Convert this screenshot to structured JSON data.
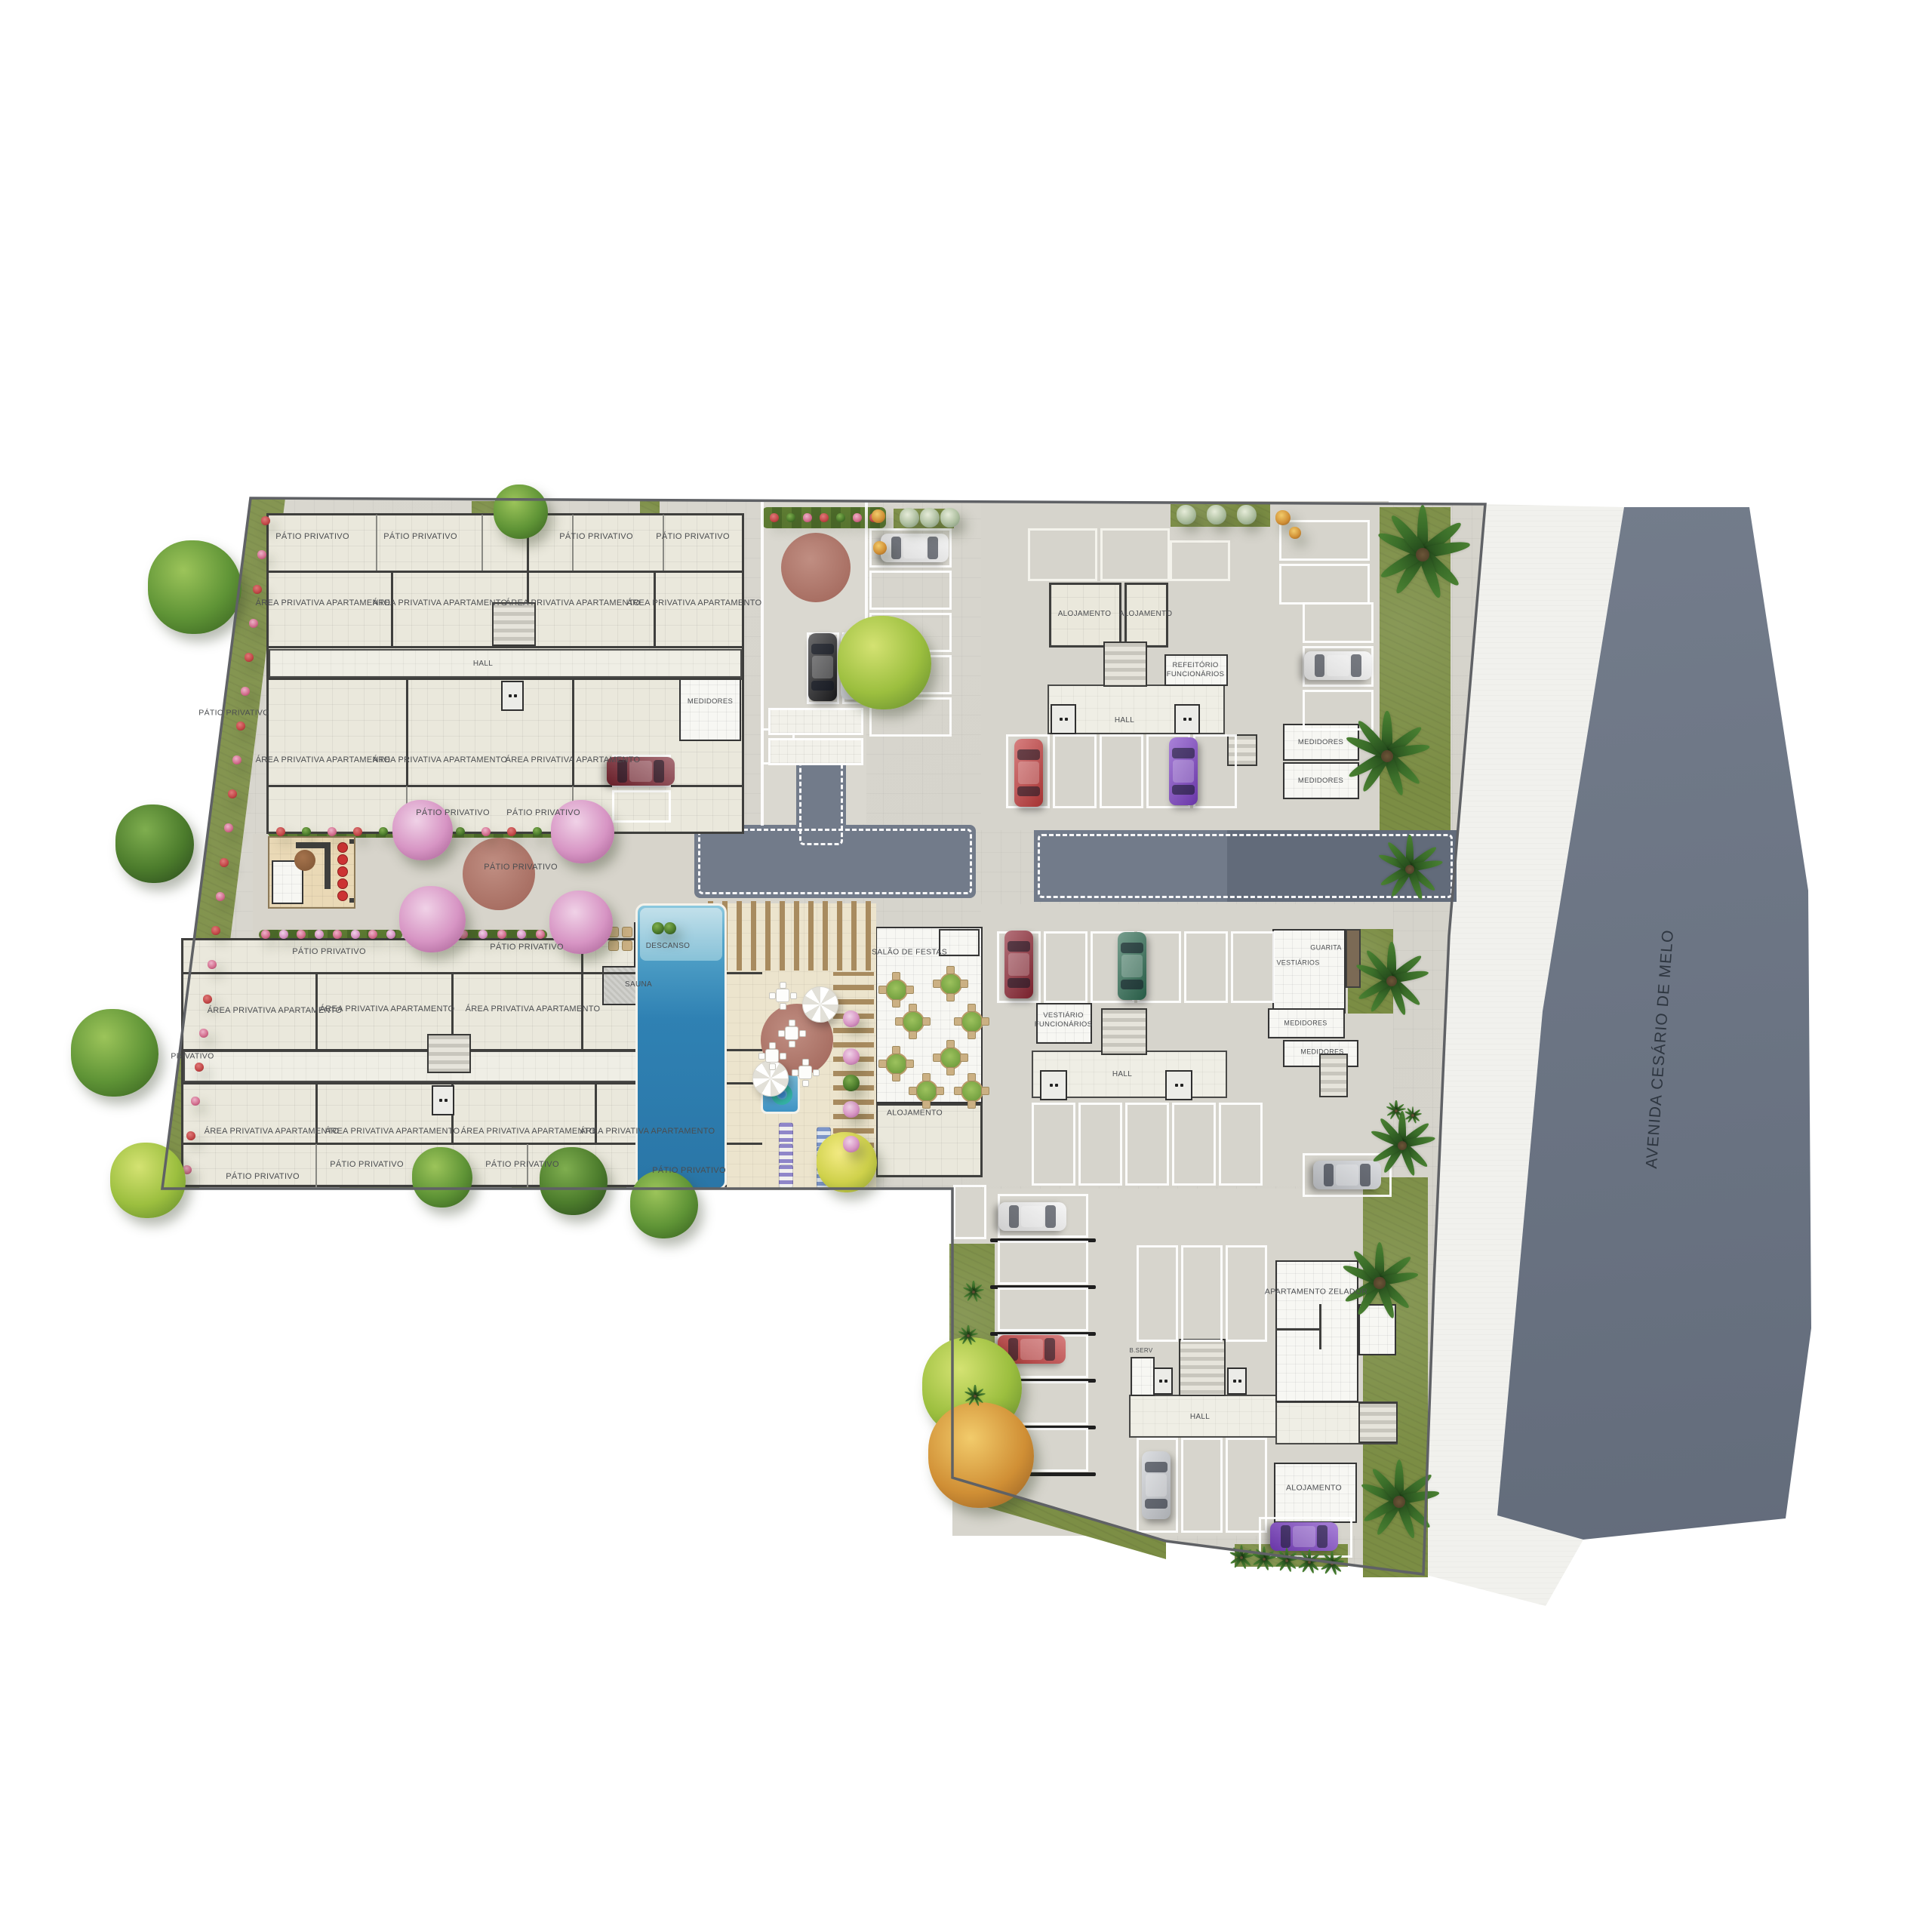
{
  "street": {
    "label": "AVENIDA CESÁRIO DE MELO"
  },
  "colors": {
    "paving": "#d8d6ce",
    "road": "#727b8a",
    "avenue_top": "#7e8796",
    "avenue_bottom": "#5d6675",
    "sidewalk": "#f1f1ed",
    "grass": "#7b8d44",
    "building_tile": "#eae8dc",
    "wall": "#3f3f3d",
    "plaza_red": "#a86f63",
    "pool_blue": "#2f81b3",
    "stall_line": "#ffffff"
  },
  "polys": {
    "site": "332,660 1968,668 1920,1240 1900,1700 1886,2086 1545,2042 1262,1958 1262,1575 215,1575",
    "sidewalk": "1968,668 2152,672 2044,1340 1984,2008 2098,2040 2048,2128 1886,2086 1900,1700 1920,1240",
    "avenue_curb": "2152,672 2168,672 2058,1340 1998,2010 1984,2008 2044,1340",
    "avenue": "2152,672 2318,672 2396,1180 2400,1760 2366,2012 2212,2028 2098,2040 1984,2008 2044,1340",
    "left_strip": "332,660 378,660 264,1575 215,1575",
    "bottom_wedge": "1262,1958 1545,2042 1545,2066 1262,1984"
  },
  "zones": [
    [
      1008,
      664,
      140,
      428,
      "#dad8d0"
    ],
    [
      335,
      1105,
      673,
      138,
      "#d7d4cb"
    ],
    [
      1300,
      664,
      540,
      436,
      "#d6d4cc"
    ],
    [
      1300,
      1198,
      546,
      374,
      "#d6d4cc"
    ],
    [
      1262,
      1575,
      606,
      460,
      "#d7d5cd"
    ]
  ],
  "roads": {
    "stem": [
      1055,
      984,
      66,
      112
    ],
    "a": [
      920,
      1093,
      373,
      97
    ],
    "b": [
      1370,
      1100,
      560,
      95
    ],
    "b_dark": [
      1626,
      1100,
      304,
      95
    ]
  },
  "curbs": [
    [
      1008,
      664,
      4,
      430
    ],
    [
      1146,
      664,
      4,
      178
    ]
  ],
  "grass": [
    [
      625,
      664,
      70,
      68
    ],
    [
      848,
      664,
      26,
      66
    ],
    [
      1184,
      674,
      80,
      26
    ],
    [
      1551,
      668,
      132,
      30
    ],
    [
      1828,
      672,
      94,
      518
    ],
    [
      1786,
      1231,
      60,
      112
    ],
    [
      1806,
      1560,
      86,
      530
    ],
    [
      1258,
      1648,
      60,
      316
    ],
    [
      450,
      1556,
      160,
      18
    ],
    [
      678,
      1556,
      152,
      18
    ],
    [
      795,
      1005,
      10,
      84
    ],
    [
      1106,
      1298,
      42,
      240
    ],
    [
      1636,
      2046,
      150,
      30
    ]
  ],
  "hedges": [
    [
      1010,
      672,
      164,
      28
    ],
    [
      355,
      1096,
      445,
      14
    ],
    [
      343,
      1232,
      190,
      13
    ],
    [
      607,
      1232,
      118,
      13
    ]
  ],
  "flower_rows": [
    [
      352,
      690,
      248,
      1550,
      20,
      "red"
    ],
    [
      372,
      1102,
      780,
      1102,
      13,
      "mix"
    ],
    [
      352,
      1238,
      518,
      1238,
      8,
      "pink"
    ],
    [
      614,
      1238,
      716,
      1238,
      5,
      "pink"
    ],
    [
      1026,
      686,
      1158,
      686,
      7,
      "mix"
    ]
  ],
  "rooms": [
    [
      353,
      680,
      633,
      425,
      "plate"
    ],
    [
      240,
      1243,
      770,
      330,
      "plate"
    ],
    [
      356,
      860,
      627,
      38,
      "cor"
    ],
    [
      243,
      1392,
      764,
      42,
      "cor"
    ],
    [
      1388,
      907,
      235,
      66,
      "cor"
    ],
    [
      1367,
      1392,
      259,
      63,
      "cor"
    ],
    [
      1496,
      1848,
      214,
      57,
      "cor"
    ],
    [
      1690,
      1857,
      162,
      57,
      "cor"
    ],
    [
      900,
      898,
      82,
      84,
      "white"
    ],
    [
      840,
      1222,
      100,
      60,
      "white"
    ],
    [
      798,
      1280,
      62,
      52,
      "gray"
    ],
    [
      898,
      1282,
      42,
      60,
      "white"
    ],
    [
      1390,
      772,
      96,
      86,
      "tile"
    ],
    [
      1490,
      772,
      58,
      86,
      "tile"
    ],
    [
      1543,
      867,
      84,
      42,
      "white"
    ],
    [
      1700,
      959,
      101,
      49,
      "white"
    ],
    [
      1700,
      1010,
      101,
      49,
      "white"
    ],
    [
      1373,
      1329,
      74,
      54,
      "white"
    ],
    [
      1686,
      1231,
      97,
      112,
      "white"
    ],
    [
      1783,
      1231,
      20,
      78,
      "brown"
    ],
    [
      1680,
      1336,
      102,
      40,
      "white"
    ],
    [
      1700,
      1378,
      100,
      36,
      "white"
    ],
    [
      1690,
      1670,
      110,
      188,
      "white"
    ],
    [
      1800,
      1728,
      50,
      68,
      "white"
    ],
    [
      1498,
      1798,
      32,
      52,
      "white"
    ],
    [
      1688,
      1938,
      110,
      80,
      "white"
    ],
    [
      1160,
      1228,
      142,
      234,
      "white"
    ],
    [
      1160,
      1462,
      142,
      98,
      "tile"
    ],
    [
      1244,
      1231,
      54,
      36,
      "white2"
    ],
    [
      963,
      1197,
      198,
      380,
      "deck"
    ],
    [
      355,
      1108,
      116,
      96,
      "tan"
    ],
    [
      360,
      1140,
      42,
      58,
      "white"
    ],
    [
      806,
      1228,
      14,
      14,
      "tan2"
    ],
    [
      824,
      1228,
      14,
      14,
      "tan2"
    ],
    [
      806,
      1246,
      14,
      14,
      "tan2"
    ],
    [
      824,
      1246,
      14,
      14,
      "tan2"
    ]
  ],
  "walls": [
    [
      353,
      756,
      633,
      3
    ],
    [
      353,
      856,
      633,
      3
    ],
    [
      353,
      898,
      633,
      3
    ],
    [
      353,
      1040,
      633,
      3
    ],
    [
      518,
      756,
      3,
      100
    ],
    [
      698,
      682,
      3,
      174
    ],
    [
      866,
      756,
      3,
      100
    ],
    [
      538,
      898,
      3,
      142
    ],
    [
      758,
      898,
      3,
      142
    ],
    [
      240,
      1288,
      770,
      3
    ],
    [
      240,
      1390,
      770,
      3
    ],
    [
      240,
      1434,
      770,
      3
    ],
    [
      240,
      1514,
      770,
      3
    ],
    [
      418,
      1288,
      3,
      102
    ],
    [
      598,
      1288,
      3,
      102
    ],
    [
      770,
      1243,
      3,
      147
    ],
    [
      418,
      1434,
      3,
      80
    ],
    [
      598,
      1434,
      3,
      80
    ],
    [
      788,
      1434,
      3,
      80
    ],
    [
      392,
      1116,
      46,
      8
    ],
    [
      430,
      1116,
      8,
      62
    ],
    [
      463,
      1112,
      6,
      6
    ],
    [
      463,
      1190,
      6,
      6
    ],
    [
      1690,
      1760,
      60,
      3
    ],
    [
      1748,
      1728,
      3,
      60
    ]
  ],
  "lwalls": [
    [
      498,
      682,
      2,
      74
    ],
    [
      638,
      682,
      2,
      74
    ],
    [
      758,
      682,
      2,
      74
    ],
    [
      878,
      682,
      2,
      74
    ],
    [
      538,
      1042,
      2,
      63
    ],
    [
      758,
      1042,
      2,
      63
    ],
    [
      418,
      1516,
      2,
      57
    ],
    [
      698,
      1516,
      2,
      57
    ]
  ],
  "stairs": [
    [
      652,
      798,
      58,
      58
    ],
    [
      566,
      1370,
      58,
      52
    ],
    [
      1462,
      850,
      58,
      60
    ],
    [
      1459,
      1336,
      61,
      62
    ],
    [
      1748,
      1396,
      38,
      58
    ],
    [
      1562,
      1774,
      62,
      76
    ],
    [
      1800,
      1858,
      52,
      54
    ],
    [
      1626,
      973,
      40,
      42
    ]
  ],
  "lifts": [
    [
      664,
      902,
      30,
      40
    ],
    [
      572,
      1438,
      30,
      40
    ],
    [
      1392,
      933,
      34,
      40
    ],
    [
      1556,
      933,
      34,
      40
    ],
    [
      1378,
      1418,
      36,
      40
    ],
    [
      1544,
      1418,
      36,
      40
    ],
    [
      1528,
      1812,
      26,
      36
    ],
    [
      1626,
      1812,
      26,
      36
    ]
  ],
  "stall_groups": [
    [
      1152,
      700,
      109,
      52,
      5,
      "col",
      "w"
    ],
    [
      1069,
      838,
      43,
      95,
      2,
      "row",
      "w"
    ],
    [
      811,
      1000,
      78,
      43,
      2,
      "col",
      "w"
    ],
    [
      1009,
      965,
      44,
      48,
      1,
      "col",
      "w"
    ],
    [
      1695,
      689,
      120,
      54,
      2,
      "col",
      "w"
    ],
    [
      1333,
      973,
      58,
      98,
      5,
      "row",
      "w"
    ],
    [
      1726,
      798,
      94,
      54,
      3,
      "col",
      "w"
    ],
    [
      1321,
      1234,
      58,
      95,
      6,
      "row",
      "w"
    ],
    [
      1367,
      1461,
      58,
      110,
      5,
      "row",
      "w"
    ],
    [
      1726,
      1528,
      118,
      58,
      1,
      "col",
      "w"
    ],
    [
      1322,
      1582,
      120,
      58,
      6,
      "col",
      "d"
    ],
    [
      1263,
      1570,
      44,
      72,
      1,
      "row",
      "w"
    ],
    [
      1506,
      1650,
      55,
      128,
      3,
      "row",
      "d"
    ],
    [
      1506,
      1905,
      55,
      126,
      3,
      "row",
      "d"
    ],
    [
      1668,
      2010,
      124,
      54,
      1,
      "col",
      "w"
    ],
    [
      1362,
      700,
      92,
      70,
      2,
      "row",
      "t"
    ],
    [
      1550,
      716,
      80,
      54,
      1,
      "row",
      "t"
    ],
    [
      1018,
      938,
      126,
      36,
      2,
      "col",
      "tile"
    ]
  ],
  "circles": [
    [
      1081,
      752,
      46,
      "red"
    ],
    [
      661,
      1158,
      48,
      "red"
    ],
    [
      1056,
      1378,
      48,
      "red"
    ],
    [
      404,
      1140,
      14,
      "grill"
    ],
    [
      453,
      1122,
      6,
      "stool"
    ],
    [
      453,
      1138,
      6,
      "stool"
    ],
    [
      453,
      1154,
      6,
      "stool"
    ],
    [
      453,
      1170,
      6,
      "stool"
    ],
    [
      453,
      1186,
      6,
      "stool"
    ]
  ],
  "pool": {
    "main": [
      842,
      1197,
      121,
      380
    ],
    "beach": [
      848,
      1203,
      109,
      70
    ],
    "kids": [
      1008,
      1420,
      52,
      56
    ],
    "float": [
      1022,
      1436,
      28,
      28
    ]
  },
  "pergolas": [
    [
      938,
      1194,
      216,
      92,
      "v"
    ],
    [
      1104,
      1288,
      54,
      252,
      "h"
    ]
  ],
  "umbrellas": [
    [
      1086,
      1330,
      23
    ],
    [
      1020,
      1428,
      23
    ]
  ],
  "tables_salao": [
    [
      1186,
      1310
    ],
    [
      1258,
      1302
    ],
    [
      1286,
      1352
    ],
    [
      1208,
      1352
    ],
    [
      1186,
      1408
    ],
    [
      1258,
      1400
    ],
    [
      1286,
      1444
    ],
    [
      1226,
      1444
    ]
  ],
  "tables_pool": [
    [
      1036,
      1318
    ],
    [
      1022,
      1398
    ],
    [
      1066,
      1420
    ],
    [
      1048,
      1368
    ]
  ],
  "loungers": [
    [
      1040,
      1502,
      "purple"
    ],
    [
      1040,
      1530,
      "purple"
    ],
    [
      1040,
      1558,
      "purple"
    ],
    [
      1090,
      1508,
      "blue"
    ],
    [
      1090,
      1534,
      "blue"
    ],
    [
      1090,
      1560,
      "blue"
    ]
  ],
  "cars": [
    [
      "#f2f2f2",
      1212,
      726,
      90
    ],
    [
      "#1d1d1f",
      1090,
      884,
      0
    ],
    [
      "#c9ccd1",
      1133,
      882,
      0
    ],
    [
      "#7a2430",
      849,
      1022,
      90
    ],
    [
      "#c23b3b",
      1363,
      1024,
      0
    ],
    [
      "#7b3fc4",
      1568,
      1022,
      0
    ],
    [
      "#f2f2f2",
      1773,
      882,
      90
    ],
    [
      "#8c2633",
      1350,
      1278,
      0
    ],
    [
      "#2e6b52",
      1500,
      1280,
      0
    ],
    [
      "#c9ccd1",
      1785,
      1557,
      90
    ],
    [
      "#f2f2f2",
      1368,
      1612,
      90
    ],
    [
      "#c23b3b",
      1367,
      1788,
      90
    ],
    [
      "#c9ccd1",
      1532,
      1968,
      0
    ],
    [
      "#7b3fc4",
      1728,
      2036,
      90
    ]
  ],
  "trees": [
    [
      "green",
      258,
      778,
      62
    ],
    [
      "dark",
      205,
      1118,
      52
    ],
    [
      "green",
      152,
      1395,
      58
    ],
    [
      "lime",
      196,
      1564,
      50
    ],
    [
      "green",
      690,
      678,
      36
    ],
    [
      "lime",
      1172,
      878,
      62
    ],
    [
      "pink",
      560,
      1100,
      40
    ],
    [
      "pink",
      772,
      1102,
      42
    ],
    [
      "pink",
      573,
      1218,
      44
    ],
    [
      "pink",
      770,
      1222,
      42
    ],
    [
      "green",
      586,
      1560,
      40
    ],
    [
      "dark",
      760,
      1565,
      45
    ],
    [
      "green",
      880,
      1596,
      45
    ],
    [
      "lime",
      1288,
      1838,
      66
    ],
    [
      "orange",
      1300,
      1928,
      70
    ],
    [
      "yellow",
      1122,
      1540,
      40
    ],
    [
      "shrub",
      1205,
      686,
      13
    ],
    [
      "shrub",
      1232,
      686,
      13
    ],
    [
      "shrub",
      1259,
      686,
      13
    ],
    [
      "shrub",
      1572,
      682,
      13
    ],
    [
      "shrub",
      1612,
      682,
      13
    ],
    [
      "shrub",
      1652,
      682,
      13
    ],
    [
      "orange",
      1164,
      684,
      9
    ],
    [
      "orange",
      1166,
      726,
      9
    ],
    [
      "orange",
      1700,
      686,
      10
    ],
    [
      "orange",
      1716,
      706,
      8
    ],
    [
      "pink",
      1128,
      1350,
      11
    ],
    [
      "pink",
      1128,
      1400,
      11
    ],
    [
      "pink",
      1128,
      1470,
      11
    ],
    [
      "pink",
      1128,
      1516,
      11
    ],
    [
      "dark",
      1128,
      1435,
      11
    ],
    [
      "dark",
      872,
      1230,
      8
    ],
    [
      "dark",
      888,
      1230,
      8
    ]
  ],
  "palms": [
    [
      1885,
      735,
      66
    ],
    [
      1838,
      1002,
      60
    ],
    [
      1868,
      1152,
      46
    ],
    [
      1844,
      1300,
      52
    ],
    [
      1858,
      1518,
      46
    ],
    [
      1828,
      1700,
      54
    ],
    [
      1854,
      1990,
      56
    ],
    [
      1850,
      1472,
      14
    ],
    [
      1872,
      1478,
      12
    ],
    [
      1290,
      1712,
      15
    ],
    [
      1283,
      1770,
      14
    ],
    [
      1292,
      1850,
      15
    ],
    [
      1645,
      2064,
      17
    ],
    [
      1675,
      2066,
      17
    ],
    [
      1705,
      2068,
      17
    ],
    [
      1735,
      2070,
      17
    ],
    [
      1765,
      2072,
      17
    ]
  ],
  "labels": [
    [
      "PÁTIO PRIVATIVO",
      414,
      712,
      11
    ],
    [
      "PÁTIO PRIVATIVO",
      557,
      712,
      11
    ],
    [
      "PÁTIO PRIVATIVO",
      790,
      712,
      11
    ],
    [
      "PÁTIO PRIVATIVO",
      918,
      712,
      11
    ],
    [
      "ÁREA PRIVATIVA APARTAMENTO",
      428,
      800,
      11
    ],
    [
      "ÁREA PRIVATIVA APARTAMENTO",
      583,
      800,
      11
    ],
    [
      "ÁREA PRIVATIVA APARTAMENTO",
      759,
      800,
      11
    ],
    [
      "ÁREA PRIVATIVA APARTAMENTO",
      920,
      800,
      11
    ],
    [
      "HALL",
      640,
      880,
      10
    ],
    [
      "MEDIDORES",
      941,
      930,
      9.5
    ],
    [
      "ÁREA PRIVATIVA APARTAMENTO",
      428,
      1008,
      11
    ],
    [
      "ÁREA PRIVATIVA APARTAMENTO",
      583,
      1008,
      11
    ],
    [
      "ÁREA PRIVATIVA APARTAMENTO",
      759,
      1008,
      11
    ],
    [
      "PÁTIO PRIVATIVO",
      310,
      945,
      10.5
    ],
    [
      "PÁTIO PRIVATIVO",
      600,
      1078,
      11
    ],
    [
      "PÁTIO PRIVATIVO",
      720,
      1078,
      11
    ],
    [
      "PÁTIO PRIVATIVO",
      690,
      1150,
      11
    ],
    [
      "PÁTIO PRIVATIVO",
      436,
      1262,
      11
    ],
    [
      "PÁTIO PRIVATIVO",
      698,
      1256,
      11
    ],
    [
      "ÁREA PRIVATIVA APARTAMENTO",
      364,
      1340,
      11
    ],
    [
      "ÁREA PRIVATIVA APARTAMENTO",
      513,
      1338,
      11
    ],
    [
      "ÁREA PRIVATIVA APARTAMENTO",
      706,
      1338,
      11
    ],
    [
      "PRIVATIVO",
      255,
      1400,
      10.5
    ],
    [
      "ÁREA PRIVATIVA APARTAMENTO",
      360,
      1500,
      11
    ],
    [
      "ÁREA PRIVATIVA APARTAMENTO",
      520,
      1500,
      11
    ],
    [
      "ÁREA PRIVATIVA APARTAMENTO",
      700,
      1500,
      11
    ],
    [
      "ÁREA PRIVATIVA APARTAMENTO",
      858,
      1500,
      11
    ],
    [
      "PÁTIO PRIVATIVO",
      348,
      1560,
      11
    ],
    [
      "PÁTIO PRIVATIVO",
      486,
      1544,
      11
    ],
    [
      "PÁTIO PRIVATIVO",
      692,
      1544,
      11
    ],
    [
      "PÁTIO PRIVATIVO",
      913,
      1552,
      11
    ],
    [
      "DESCANSO",
      885,
      1254,
      10
    ],
    [
      "SAUNA",
      846,
      1305,
      10
    ],
    [
      "SALÃO DE FESTAS",
      1205,
      1262,
      10.5
    ],
    [
      "ALOJAMENTO",
      1212,
      1475,
      10.5
    ],
    [
      "ALOJAMENTO",
      1437,
      814,
      10
    ],
    [
      "ALOJAMENTO",
      1518,
      814,
      10
    ],
    [
      "REFEITÓRIO\nFUNCIONÁRIOS",
      1584,
      888,
      9.5
    ],
    [
      "HALL",
      1490,
      955,
      10
    ],
    [
      "MEDIDORES",
      1750,
      984,
      9.5
    ],
    [
      "MEDIDORES",
      1750,
      1035,
      9.5
    ],
    [
      "VESTIÁRIO\nFUNCIONÁRIOS",
      1409,
      1352,
      9.5
    ],
    [
      "HALL",
      1487,
      1424,
      10
    ],
    [
      "GUARITA",
      1757,
      1256,
      9
    ],
    [
      "VESTIÁRIOS",
      1720,
      1276,
      9
    ],
    [
      "MEDIDORES",
      1730,
      1356,
      9
    ],
    [
      "MEDIDORES",
      1752,
      1394,
      9
    ],
    [
      "APARTAMENTO ZELADOR",
      1744,
      1712,
      10.5
    ],
    [
      "B.SERV",
      1512,
      1790,
      8
    ],
    [
      "HALL",
      1590,
      1878,
      10
    ],
    [
      "ALOJAMENTO",
      1741,
      1972,
      10.5
    ]
  ],
  "street_label_pos": [
    2200,
    1390
  ]
}
